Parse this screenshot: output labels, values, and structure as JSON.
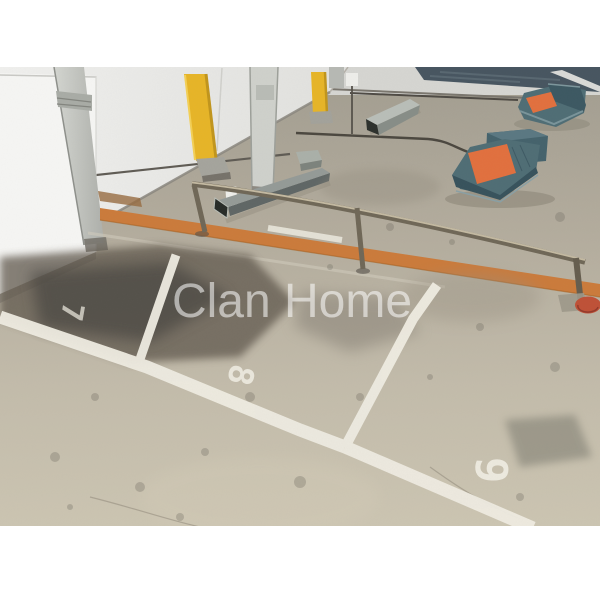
{
  "photo": {
    "subject": "indoor-parking-garage-stalls"
  },
  "watermark": {
    "text": "Clan Home",
    "color": "#ffffff"
  },
  "parking": {
    "marking_color": "#f2efe5",
    "stalls": [
      {
        "number": "7"
      },
      {
        "number": "8"
      },
      {
        "number": "9"
      }
    ]
  },
  "colors": {
    "letterbox": "#ffffff",
    "floor_far": "#a29d90",
    "floor_near": "#ccc5b2",
    "wall": "#ececea",
    "orange_floor_line": "#cb7b3b",
    "bollard_yellow": "#e7b527",
    "wheel_stop_teal": "#4f6d75",
    "wheel_stop_orange": "#e2703e",
    "railing_steel": "#6f6757",
    "rail_base_orange": "#bf5137"
  }
}
